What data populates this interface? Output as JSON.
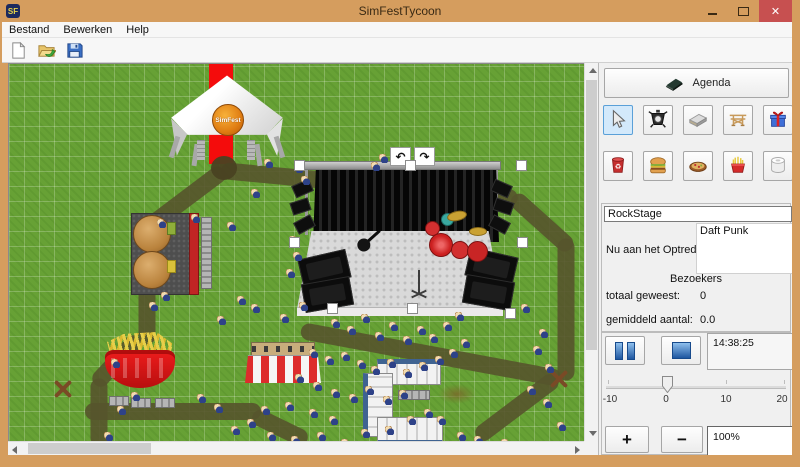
{
  "window": {
    "title": "SimFestTycoon",
    "logo": "SF",
    "close_glyph": "✕"
  },
  "menu": {
    "items": [
      "Bestand",
      "Bewerken",
      "Help"
    ]
  },
  "toolbar": {
    "buttons": [
      "new-file",
      "open-file",
      "save-file"
    ]
  },
  "map": {
    "tent_logo": "SimFest",
    "undo_glyph": "↶",
    "redo_glyph": "↷",
    "paths": [
      {
        "x": 212,
        "y": 107,
        "len": 298,
        "rot": 5.4
      },
      {
        "x": 504,
        "y": 133,
        "len": 78,
        "rot": 42
      },
      {
        "x": 557,
        "y": 175,
        "len": 142,
        "rot": 90
      },
      {
        "x": 292,
        "y": 267,
        "len": 264,
        "rot": 10.5
      },
      {
        "x": 468,
        "y": 374,
        "len": 100,
        "rot": -37
      },
      {
        "x": 132,
        "y": 169,
        "len": 104,
        "rot": -37
      },
      {
        "x": 138,
        "y": 163,
        "len": 118,
        "rot": 90
      },
      {
        "x": 86,
        "y": 321,
        "len": 64,
        "rot": -47
      },
      {
        "x": 90,
        "y": 315,
        "len": 68,
        "rot": 90
      },
      {
        "x": 76,
        "y": 348,
        "len": 176,
        "rot": 0
      },
      {
        "x": 244,
        "y": 351,
        "len": 60,
        "rot": 26
      }
    ],
    "handles": [
      [
        285,
        96
      ],
      [
        396,
        96
      ],
      [
        507,
        96
      ],
      [
        280,
        173
      ],
      [
        508,
        173
      ],
      [
        318,
        239
      ],
      [
        398,
        239
      ],
      [
        496,
        244
      ]
    ],
    "people": [
      [
        255,
        95
      ],
      [
        285,
        100
      ],
      [
        292,
        112
      ],
      [
        242,
        125
      ],
      [
        362,
        98
      ],
      [
        370,
        90
      ],
      [
        280,
        172
      ],
      [
        284,
        188
      ],
      [
        277,
        205
      ],
      [
        290,
        238
      ],
      [
        271,
        250
      ],
      [
        148,
        155
      ],
      [
        182,
        150
      ],
      [
        218,
        158
      ],
      [
        152,
        228
      ],
      [
        140,
        238
      ],
      [
        228,
        232
      ],
      [
        242,
        240
      ],
      [
        208,
        252
      ],
      [
        322,
        255
      ],
      [
        338,
        262
      ],
      [
        352,
        250
      ],
      [
        366,
        268
      ],
      [
        380,
        258
      ],
      [
        394,
        272
      ],
      [
        408,
        262
      ],
      [
        420,
        270
      ],
      [
        434,
        258
      ],
      [
        446,
        248
      ],
      [
        300,
        285
      ],
      [
        316,
        292
      ],
      [
        332,
        288
      ],
      [
        348,
        296
      ],
      [
        362,
        302
      ],
      [
        378,
        295
      ],
      [
        394,
        305
      ],
      [
        410,
        298
      ],
      [
        426,
        292
      ],
      [
        440,
        285
      ],
      [
        452,
        275
      ],
      [
        286,
        310
      ],
      [
        304,
        318
      ],
      [
        322,
        325
      ],
      [
        340,
        330
      ],
      [
        356,
        322
      ],
      [
        374,
        332
      ],
      [
        390,
        326
      ],
      [
        300,
        345
      ],
      [
        320,
        352
      ],
      [
        276,
        338
      ],
      [
        252,
        342
      ],
      [
        238,
        355
      ],
      [
        222,
        362
      ],
      [
        258,
        368
      ],
      [
        282,
        372
      ],
      [
        308,
        368
      ],
      [
        332,
        375
      ],
      [
        352,
        365
      ],
      [
        376,
        362
      ],
      [
        398,
        352
      ],
      [
        415,
        345
      ],
      [
        428,
        352
      ],
      [
        512,
        240
      ],
      [
        536,
        300
      ],
      [
        524,
        282
      ],
      [
        530,
        265
      ],
      [
        518,
        322
      ],
      [
        534,
        335
      ],
      [
        548,
        358
      ],
      [
        492,
        375
      ],
      [
        465,
        372
      ],
      [
        448,
        368
      ],
      [
        102,
        295
      ],
      [
        122,
        328
      ],
      [
        108,
        342
      ],
      [
        95,
        368
      ],
      [
        188,
        330
      ],
      [
        205,
        340
      ]
    ]
  },
  "panel": {
    "agenda_label": "Agenda",
    "tools": [
      {
        "name": "select",
        "selected": true
      },
      {
        "name": "spotlight",
        "selected": false
      },
      {
        "name": "stage",
        "selected": false
      },
      {
        "name": "frame",
        "selected": false
      },
      {
        "name": "gift",
        "selected": false
      },
      {
        "name": "trash",
        "selected": false
      },
      {
        "name": "burger",
        "selected": false
      },
      {
        "name": "food",
        "selected": false
      },
      {
        "name": "fries",
        "selected": false
      },
      {
        "name": "toilet",
        "selected": false
      }
    ],
    "stage_name": "RockStage",
    "now_playing_label": "Nu aan het Optreden:",
    "now_playing": "Daft Punk",
    "visitors_header": "Bezoekers",
    "total_label": "totaal geweest:",
    "total_value": "0",
    "average_label": "gemiddeld aantal:",
    "average_value": "0.0",
    "time": "14:38:25",
    "slider": {
      "ticks": [
        "-10",
        "0",
        "10",
        "20"
      ]
    },
    "zoom_in": "+",
    "zoom_out": "−",
    "zoom_value": "100%"
  },
  "colors": {
    "titlebar": "#d59d5e",
    "close_button": "#c75050",
    "grass": "#67a135",
    "path": "#56542c",
    "carpet": "#f40c0c",
    "selected_tool_bg": "#d3e9fb",
    "media_blue": "#1e56a0"
  }
}
